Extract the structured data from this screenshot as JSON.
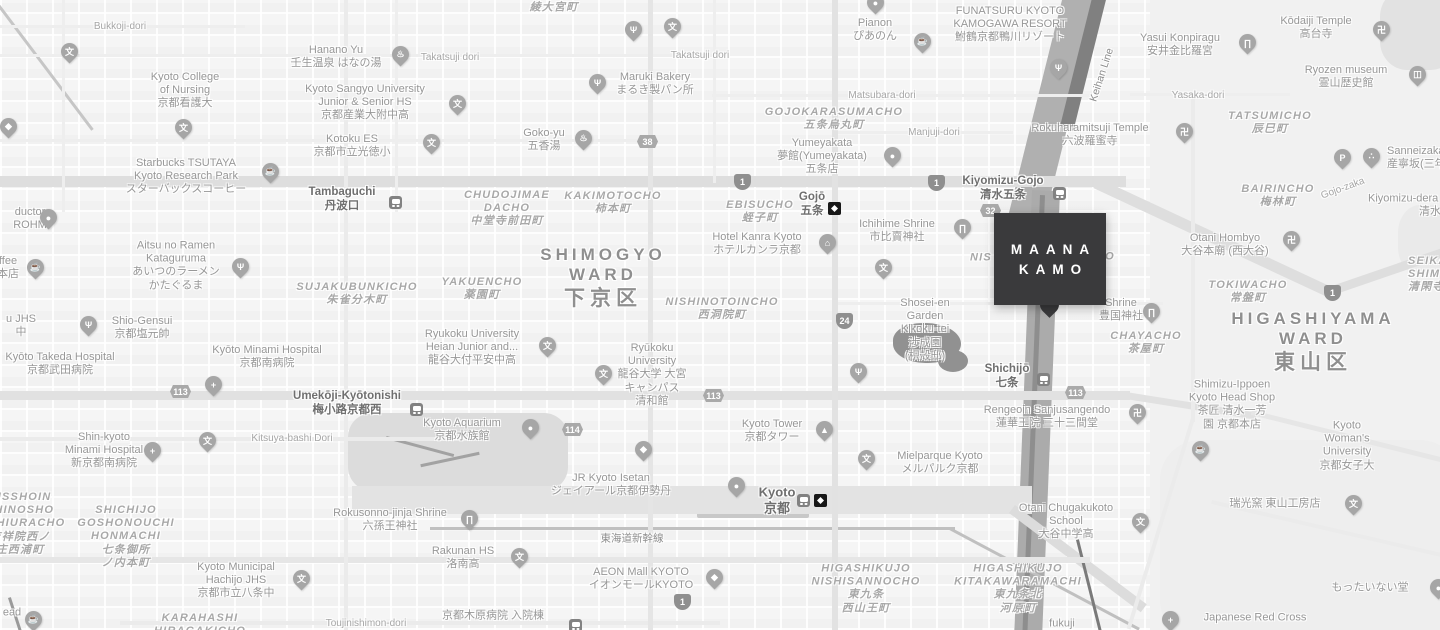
{
  "map": {
    "marker": {
      "line1": "MAANA",
      "line2": "KAMO",
      "color": "#3a3a3c",
      "text_color": "#ffffff"
    },
    "colors": {
      "background": "#f5f5f5",
      "river": "#adadad",
      "railway": "#808080",
      "major_road": "#dedede",
      "label": "#979797"
    },
    "pin_glyphs": {
      "school": "文",
      "restaurant": "Ψ",
      "cafe": "☕",
      "spa": "♨",
      "temple": "卍",
      "shrine": "∏",
      "hotel": "⌂",
      "hospital": "+",
      "parking": "P",
      "museum": "◫",
      "dots": "∴",
      "shopping": "◆",
      "tower": "▲",
      "generic": "●"
    },
    "labels": [
      {
        "s": "road",
        "x": 120,
        "y": 27,
        "lines": [
          "Bukkoji-dori"
        ]
      },
      {
        "s": "poi",
        "x": 185,
        "y": 91,
        "lines": [
          "Kyoto College",
          "of Nursing",
          "京都看護大"
        ]
      },
      {
        "s": "poi",
        "x": 336,
        "y": 57,
        "lines": [
          "Hanano Yu",
          "壬生温泉 はなの湯"
        ]
      },
      {
        "s": "road",
        "x": 450,
        "y": 58,
        "lines": [
          "Takatsuji dori"
        ]
      },
      {
        "s": "road",
        "x": 700,
        "y": 56,
        "lines": [
          "Takatsuji dori"
        ]
      },
      {
        "s": "poi",
        "x": 365,
        "y": 103,
        "lines": [
          "Kyoto Sangyo University",
          "Junior & Senior HS",
          "京都産業大附中高"
        ]
      },
      {
        "s": "poi",
        "x": 352,
        "y": 146,
        "lines": [
          "Kotoku ES",
          "京都市立光徳小"
        ]
      },
      {
        "s": "poi",
        "x": 544,
        "y": 140,
        "lines": [
          "Goko-yu",
          "五香湯"
        ]
      },
      {
        "s": "poi",
        "x": 655,
        "y": 84,
        "lines": [
          "Maruki Bakery",
          "まるき製パン所"
        ]
      },
      {
        "s": "area",
        "x": 554,
        "y": 8,
        "lines": [
          "綾大宮町"
        ]
      },
      {
        "s": "poi",
        "x": 875,
        "y": 30,
        "lines": [
          "Pianon",
          "ぴあのん"
        ]
      },
      {
        "s": "poi",
        "x": 1010,
        "y": 25,
        "lines": [
          "FUNATSURU KYOTO",
          "KAMOGAWA RESORT",
          "鮒鶴京都鴨川リゾート"
        ]
      },
      {
        "s": "road",
        "x": 882,
        "y": 96,
        "lines": [
          "Matsubara-dori"
        ]
      },
      {
        "s": "area",
        "x": 834,
        "y": 119,
        "lines": [
          "GOJOKARASUMACHO",
          "五条烏丸町"
        ]
      },
      {
        "s": "road",
        "x": 934,
        "y": 133,
        "lines": [
          "Manjuji-dori"
        ]
      },
      {
        "s": "poi",
        "x": 822,
        "y": 157,
        "lines": [
          "Yumeyakata",
          "夢館(Yumeyakata)",
          "五条店"
        ]
      },
      {
        "s": "poi",
        "x": 1090,
        "y": 135,
        "lines": [
          "Rokuharamitsuji Temple",
          "六波羅蜜寺"
        ]
      },
      {
        "s": "poi",
        "x": 1180,
        "y": 45,
        "lines": [
          "Yasui Konpiragu",
          "安井金比羅宮"
        ]
      },
      {
        "s": "poi",
        "x": 1316,
        "y": 28,
        "lines": [
          "Kōdaiji Temple",
          "高台寺"
        ]
      },
      {
        "s": "poi",
        "x": 1346,
        "y": 77,
        "lines": [
          "Ryozen museum",
          "霊山歴史館"
        ]
      },
      {
        "s": "road",
        "x": 1198,
        "y": 96,
        "lines": [
          "Yasaka-dori"
        ]
      },
      {
        "s": "area",
        "x": 1270,
        "y": 123,
        "lines": [
          "TATSUMICHO",
          "辰巳町"
        ]
      },
      {
        "s": "poi",
        "la": true,
        "x": 1387,
        "y": 158,
        "lines": [
          "Sanneizaka",
          "産寧坂(三年坂)"
        ]
      },
      {
        "s": "area",
        "x": 1278,
        "y": 196,
        "lines": [
          "BAIRINCHO",
          "梅林町"
        ]
      },
      {
        "s": "road",
        "x": 1343,
        "y": 189,
        "rot": -20,
        "lines": [
          "Gojo-zaka"
        ]
      },
      {
        "s": "poi",
        "la": true,
        "x": 1368,
        "y": 199,
        "lines": [
          "Kiyomizu-dera"
        ]
      },
      {
        "s": "poi",
        "la": true,
        "x": 1419,
        "y": 212,
        "lines": [
          "清水寺"
        ]
      },
      {
        "s": "rail",
        "x": 1102,
        "y": 75,
        "rot": -72,
        "lines": [
          "Keihan Line"
        ]
      },
      {
        "s": "poi",
        "x": 186,
        "y": 177,
        "lines": [
          "Starbucks TSUTAYA",
          "Kyoto Research Park",
          "スターバックスコーヒー"
        ]
      },
      {
        "s": "poi",
        "x": 30,
        "y": 219,
        "lines": [
          "ductor",
          "ROHM"
        ]
      },
      {
        "s": "poi",
        "x": 8,
        "y": 268,
        "lines": [
          "ffee",
          "本店"
        ]
      },
      {
        "s": "poi",
        "x": 176,
        "y": 266,
        "lines": [
          "Aitsu no Ramen",
          "Kataguruma",
          "あいつのラーメン",
          "かたぐるま"
        ]
      },
      {
        "s": "area",
        "x": 357,
        "y": 294,
        "lines": [
          "SUJAKUBUNKICHO",
          "朱雀分木町"
        ]
      },
      {
        "s": "poi",
        "x": 142,
        "y": 328,
        "lines": [
          "Shio-Gensui",
          "京都塩元帥"
        ]
      },
      {
        "s": "poi",
        "x": 21,
        "y": 326,
        "lines": [
          "u JHS",
          "中"
        ]
      },
      {
        "s": "poi",
        "x": 60,
        "y": 364,
        "lines": [
          "Kyōto Takeda Hospital",
          "京都武田病院"
        ]
      },
      {
        "s": "poi",
        "x": 267,
        "y": 357,
        "lines": [
          "Kyōto Minami Hospital",
          "京都南病院"
        ]
      },
      {
        "s": "station",
        "x": 347,
        "y": 404,
        "lines": [
          "Umekōji-Kyōtonishi",
          "梅小路京都西"
        ]
      },
      {
        "s": "poi",
        "x": 104,
        "y": 451,
        "lines": [
          "Shin-kyoto",
          "Minami Hospital",
          "新京都南病院"
        ]
      },
      {
        "s": "road",
        "x": 292,
        "y": 439,
        "lines": [
          "Kitsuya-bashi Dori"
        ]
      },
      {
        "s": "area",
        "x": 20,
        "y": 524,
        "lines": [
          "KISSHOIN",
          "SHINOSHO",
          "NISHIURACHO",
          "吉祥院西ノ",
          "庄西浦町"
        ]
      },
      {
        "s": "area",
        "x": 126,
        "y": 537,
        "lines": [
          "SHICHIJO",
          "GOSHONOUCHI",
          "HONMACHI",
          "七条御所",
          "ノ内本町"
        ]
      },
      {
        "s": "poi",
        "x": 236,
        "y": 581,
        "lines": [
          "Kyoto Municipal",
          "Hachijo JHS",
          "京都市立八条中"
        ]
      },
      {
        "s": "area",
        "x": 200,
        "y": 625,
        "lines": [
          "KARAHASHI",
          "HIRAGAKICHO"
        ]
      },
      {
        "s": "poi",
        "x": 12,
        "y": 613,
        "lines": [
          "ead"
        ]
      },
      {
        "s": "poi",
        "x": 390,
        "y": 520,
        "lines": [
          "Rokusonno-jinja Shrine",
          "六孫王神社"
        ]
      },
      {
        "s": "poi",
        "x": 463,
        "y": 558,
        "lines": [
          "Rakunan HS",
          "洛南高"
        ]
      },
      {
        "s": "poi",
        "x": 462,
        "y": 430,
        "lines": [
          "Kyoto Aquarium",
          "京都水族館"
        ]
      },
      {
        "s": "poi",
        "x": 611,
        "y": 485,
        "lines": [
          "JR Kyoto Isetan",
          "ジェイアール京都伊勢丹"
        ]
      },
      {
        "s": "rail",
        "x": 632,
        "y": 539,
        "lines": [
          "東海道新幹線"
        ]
      },
      {
        "s": "poi",
        "x": 641,
        "y": 579,
        "lines": [
          "AEON Mall KYOTO",
          "イオンモールKYOTO"
        ]
      },
      {
        "s": "poi",
        "x": 493,
        "y": 616,
        "lines": [
          "京都木原病院 入院棟"
        ]
      },
      {
        "s": "road",
        "x": 366,
        "y": 624,
        "lines": [
          "Toujinishimon-dori"
        ]
      },
      {
        "s": "poi",
        "x": 772,
        "y": 431,
        "lines": [
          "Kyoto Tower",
          "京都タワー"
        ]
      },
      {
        "s": "poi",
        "x": 940,
        "y": 463,
        "lines": [
          "Mielparque Kyoto",
          "メルパルク京都"
        ]
      },
      {
        "s": "station",
        "x": 777,
        "y": 500,
        "sz": 13,
        "lines": [
          "Kyoto",
          "京都"
        ]
      },
      {
        "s": "area",
        "x": 866,
        "y": 589,
        "lines": [
          "HIGASHIKUJO",
          "NISHISANNOCHO",
          "東九条",
          "西山王町"
        ]
      },
      {
        "s": "area",
        "x": 1018,
        "y": 589,
        "lines": [
          "HIGASHIKUJO",
          "KITAKAWARAMACHI",
          "東九条北",
          "河原町"
        ]
      },
      {
        "s": "poi",
        "x": 1066,
        "y": 522,
        "lines": [
          "Otani Chugakukoto",
          "School",
          "大谷中学高"
        ]
      },
      {
        "s": "poi",
        "x": 1047,
        "y": 417,
        "lines": [
          "Rengeoin Sanjusangendo",
          "蓮華王院 三十三間堂"
        ]
      },
      {
        "s": "poi",
        "x": 1232,
        "y": 405,
        "lines": [
          "Shimizu-Ippoen",
          "Kyoto Head Shop",
          "茶匠 清水一芳",
          "園 京都本店"
        ]
      },
      {
        "s": "poi",
        "x": 1347,
        "y": 446,
        "lines": [
          "Kyoto",
          "Woman's",
          "University",
          "京都女子大"
        ]
      },
      {
        "s": "poi",
        "x": 1275,
        "y": 504,
        "lines": [
          "瑞光窯 東山工房店"
        ]
      },
      {
        "s": "poi",
        "x": 1370,
        "y": 588,
        "lines": [
          "もったいない堂"
        ]
      },
      {
        "s": "poi",
        "x": 1255,
        "y": 618,
        "lines": [
          "Japanese Red Cross"
        ]
      },
      {
        "s": "poi",
        "x": 1062,
        "y": 624,
        "lines": [
          "fukuji"
        ]
      },
      {
        "s": "station",
        "x": 1003,
        "y": 189,
        "lines": [
          "Kiyomizu-Gojo",
          "清水五条"
        ]
      },
      {
        "s": "station",
        "x": 812,
        "y": 205,
        "lines": [
          "Gojō",
          "五条"
        ]
      },
      {
        "s": "area",
        "x": 760,
        "y": 212,
        "lines": [
          "EBISUCHO",
          "蛭子町"
        ]
      },
      {
        "s": "poi",
        "x": 757,
        "y": 244,
        "lines": [
          "Hotel Kanra Kyoto",
          "ホテルカンラ京都"
        ]
      },
      {
        "s": "poi",
        "x": 897,
        "y": 231,
        "lines": [
          "Ichihime Shrine",
          "市比賣神社"
        ]
      },
      {
        "s": "area",
        "x": 981,
        "y": 258,
        "lines": [
          "NIS"
        ]
      },
      {
        "s": "area",
        "x": 1110,
        "y": 257,
        "lines": [
          "O"
        ]
      },
      {
        "s": "poi",
        "x": 925,
        "y": 330,
        "lines": [
          "Shosei-en",
          "Garden",
          "Kikoku-tei",
          "渉成園",
          "(枳殻邸)"
        ]
      },
      {
        "s": "station",
        "x": 1007,
        "y": 377,
        "lines": [
          "Shichijō",
          "七条"
        ]
      },
      {
        "s": "area",
        "x": 507,
        "y": 209,
        "lines": [
          "CHUDOJIMAE",
          "DACHO",
          "中堂寺前田町"
        ]
      },
      {
        "s": "area",
        "x": 613,
        "y": 203,
        "lines": [
          "KAKIMOTOCHO",
          "柿本町"
        ]
      },
      {
        "s": "station",
        "x": 342,
        "y": 200,
        "lines": [
          "Tambaguchi",
          "丹波口"
        ]
      },
      {
        "s": "area",
        "x": 482,
        "y": 289,
        "lines": [
          "YAKUENCHO",
          "薬園町"
        ]
      },
      {
        "s": "ward",
        "x": 603,
        "y": 278,
        "lines": [
          "SHIMOGYO",
          "WARD",
          "下京区"
        ]
      },
      {
        "s": "area",
        "x": 722,
        "y": 309,
        "lines": [
          "NISHINOTOINCHO",
          "西洞院町"
        ]
      },
      {
        "s": "poi",
        "x": 472,
        "y": 348,
        "lines": [
          "Ryukoku University",
          "Heian Junior and...",
          "龍谷大付平安中高"
        ]
      },
      {
        "s": "poi",
        "x": 652,
        "y": 375,
        "lines": [
          "Ryūkoku",
          "University",
          "龍谷大学 大宮",
          "キャンパス",
          "清和館"
        ]
      },
      {
        "s": "poi",
        "x": 1225,
        "y": 245,
        "lines": [
          "Otani Hombyo",
          "大谷本廟 (西大谷)"
        ]
      },
      {
        "s": "area",
        "x": 1248,
        "y": 292,
        "lines": [
          "TOKIWACHO",
          "常盤町"
        ]
      },
      {
        "s": "area",
        "la": true,
        "x": 1408,
        "y": 275,
        "lines": [
          "SEIKANJI",
          "SHIMOYAMACHO",
          "清閑寺下山町"
        ]
      },
      {
        "s": "ward",
        "x": 1313,
        "y": 342,
        "lines": [
          "HIGASHIYAMA",
          "WARD",
          "東山区"
        ]
      },
      {
        "s": "area",
        "x": 1146,
        "y": 343,
        "lines": [
          "CHAYACHO",
          "茶屋町"
        ]
      },
      {
        "s": "poi",
        "x": 1121,
        "y": 310,
        "lines": [
          "Shrine",
          "豊国神社"
        ]
      }
    ],
    "pins": [
      {
        "t": "school",
        "x": 69,
        "y": 52
      },
      {
        "t": "school",
        "x": 183,
        "y": 128
      },
      {
        "t": "school",
        "x": 457,
        "y": 104
      },
      {
        "t": "school",
        "x": 431,
        "y": 143
      },
      {
        "t": "school",
        "x": 672,
        "y": 27
      },
      {
        "t": "school",
        "x": 547,
        "y": 346
      },
      {
        "t": "school",
        "x": 603,
        "y": 374
      },
      {
        "t": "school",
        "x": 883,
        "y": 268
      },
      {
        "t": "school",
        "x": 866,
        "y": 459
      },
      {
        "t": "school",
        "x": 519,
        "y": 557
      },
      {
        "t": "school",
        "x": 301,
        "y": 579
      },
      {
        "t": "school",
        "x": 207,
        "y": 441
      },
      {
        "t": "school",
        "x": 1353,
        "y": 504
      },
      {
        "t": "school",
        "x": 1140,
        "y": 522
      },
      {
        "t": "restaurant",
        "x": 240,
        "y": 267
      },
      {
        "t": "restaurant",
        "x": 88,
        "y": 325
      },
      {
        "t": "restaurant",
        "x": 633,
        "y": 30
      },
      {
        "t": "restaurant",
        "x": 1058,
        "y": 68
      },
      {
        "t": "restaurant",
        "x": 858,
        "y": 372
      },
      {
        "t": "restaurant",
        "x": 597,
        "y": 83
      },
      {
        "t": "cafe",
        "x": 270,
        "y": 172
      },
      {
        "t": "cafe",
        "x": 35,
        "y": 268
      },
      {
        "t": "cafe",
        "x": 922,
        "y": 42
      },
      {
        "t": "cafe",
        "x": 1200,
        "y": 450
      },
      {
        "t": "cafe",
        "x": 33,
        "y": 620
      },
      {
        "t": "spa",
        "x": 400,
        "y": 55
      },
      {
        "t": "spa",
        "x": 583,
        "y": 139
      },
      {
        "t": "temple",
        "x": 1184,
        "y": 132
      },
      {
        "t": "temple",
        "x": 1291,
        "y": 240
      },
      {
        "t": "temple",
        "x": 1381,
        "y": 30
      },
      {
        "t": "temple",
        "x": 1137,
        "y": 413
      },
      {
        "t": "shrine",
        "x": 962,
        "y": 228
      },
      {
        "t": "shrine",
        "x": 1151,
        "y": 312
      },
      {
        "t": "shrine",
        "x": 469,
        "y": 519
      },
      {
        "t": "shrine",
        "x": 1247,
        "y": 43
      },
      {
        "t": "hotel",
        "x": 827,
        "y": 243
      },
      {
        "t": "hospital",
        "x": 213,
        "y": 385
      },
      {
        "t": "hospital",
        "x": 152,
        "y": 451
      },
      {
        "t": "hospital",
        "x": 1170,
        "y": 620
      },
      {
        "t": "parking",
        "x": 1342,
        "y": 158
      },
      {
        "t": "museum",
        "x": 1417,
        "y": 75
      },
      {
        "t": "dots",
        "x": 1371,
        "y": 157
      },
      {
        "t": "shopping",
        "x": 643,
        "y": 450
      },
      {
        "t": "shopping",
        "x": 714,
        "y": 578
      },
      {
        "t": "shopping",
        "x": 8,
        "y": 127
      },
      {
        "t": "tower",
        "x": 824,
        "y": 430
      },
      {
        "t": "generic",
        "x": 530,
        "y": 428
      },
      {
        "t": "generic",
        "x": 48,
        "y": 218
      },
      {
        "t": "generic",
        "x": 892,
        "y": 156
      },
      {
        "t": "generic",
        "x": 875,
        "y": 3
      },
      {
        "t": "generic",
        "x": 736,
        "y": 486
      },
      {
        "t": "generic",
        "x": 1438,
        "y": 588
      }
    ],
    "shields": [
      {
        "k": "nat",
        "n": "1",
        "x": 743,
        "y": 181
      },
      {
        "k": "nat",
        "n": "1",
        "x": 937,
        "y": 182
      },
      {
        "k": "nat",
        "n": "1",
        "x": 1333,
        "y": 292
      },
      {
        "k": "nat",
        "n": "1",
        "x": 683,
        "y": 601
      },
      {
        "k": "nat",
        "n": "24",
        "x": 845,
        "y": 320
      },
      {
        "k": "pref",
        "n": "113",
        "x": 179,
        "y": 392
      },
      {
        "k": "pref",
        "n": "113",
        "x": 712,
        "y": 396
      },
      {
        "k": "pref",
        "n": "113",
        "x": 1074,
        "y": 393
      },
      {
        "k": "pref",
        "n": "114",
        "x": 571,
        "y": 430
      },
      {
        "k": "pref",
        "n": "38",
        "x": 646,
        "y": 142
      },
      {
        "k": "pref",
        "n": "32",
        "x": 989,
        "y": 211
      }
    ],
    "stations": [
      {
        "k": "jr",
        "x": 395,
        "y": 202
      },
      {
        "k": "jr",
        "x": 416,
        "y": 409
      },
      {
        "k": "jr",
        "x": 1059,
        "y": 193
      },
      {
        "k": "jr",
        "x": 1043,
        "y": 379
      },
      {
        "k": "jr",
        "x": 803,
        "y": 500
      },
      {
        "k": "jr",
        "x": 575,
        "y": 625
      },
      {
        "k": "subway",
        "x": 834,
        "y": 208
      },
      {
        "k": "subway",
        "x": 820,
        "y": 500
      }
    ]
  }
}
